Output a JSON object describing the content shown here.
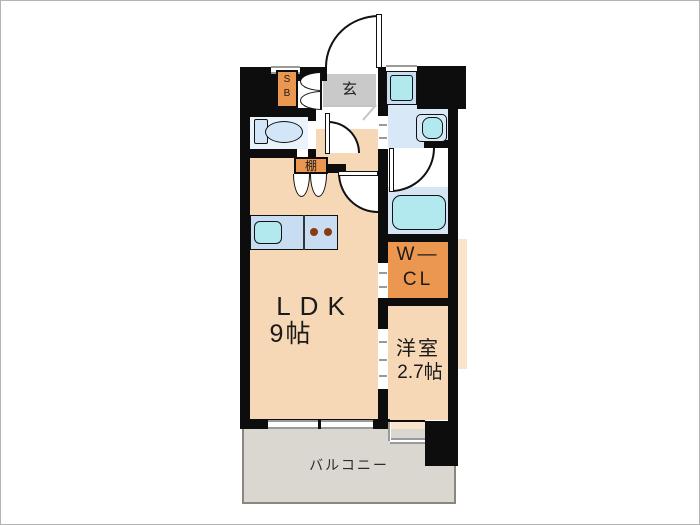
{
  "floorplan": {
    "rooms": {
      "entrance": {
        "label": "玄"
      },
      "shoe_box": {
        "line1": "S",
        "line2": "B"
      },
      "shelf": {
        "label": "棚"
      },
      "ldk": {
        "label": "LDK",
        "size": "9帖"
      },
      "walk_in_closet": {
        "line1": "W—",
        "line2": "CL"
      },
      "western_room": {
        "label": "洋室",
        "size": "2.7帖"
      },
      "balcony": {
        "label": "バルコニー"
      }
    },
    "fixtures": [
      "toilet",
      "kitchen-counter",
      "kitchen-sink",
      "stove-burners",
      "washing-machine-pan",
      "washbasin",
      "bathtub"
    ],
    "colors": {
      "wall": "#0d0d0d",
      "room_peach": "#f7d8b6",
      "room_peach_light": "#f9e3ca",
      "accent_orange": "#eb9750",
      "entrance_gray": "#c9c9c9",
      "balcony_gray": "#dad6d0",
      "balcony_border": "#8b8780",
      "water_blue": "#d8e8f6",
      "bath_blue": "#d5e5f3",
      "counter_blue": "#c8dcf2",
      "fixture_cyan": "#b2e9ee",
      "toilet_blue": "#d2e6f8",
      "toilet_floor": "#eaf2fb",
      "window_gray": "#9a9a9a",
      "burner_brown": "#8a3c10",
      "text": "#1a1a1a"
    }
  }
}
